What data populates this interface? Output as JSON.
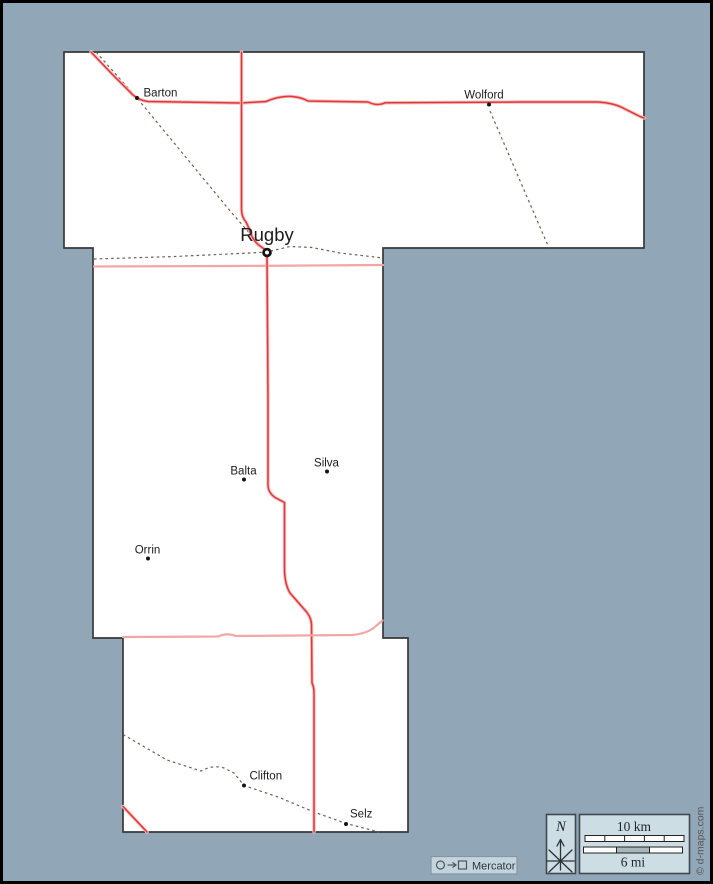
{
  "towns": [
    {
      "label": "Barton"
    },
    {
      "label": "Wolford"
    },
    {
      "label": "Rugby"
    },
    {
      "label": "Balta"
    },
    {
      "label": "Silva"
    },
    {
      "label": "Orrin"
    },
    {
      "label": "Clifton"
    },
    {
      "label": "Selz"
    }
  ],
  "legend": {
    "north": "N",
    "scale_km": "10 km",
    "scale_mi": "6 mi",
    "projection": "Mercator",
    "credit": "© d-maps.com"
  },
  "colors": {
    "background": "#91a7b8",
    "county_fill": "#ffffff",
    "county_border": "#383838",
    "road_primary": "#df3838",
    "road_casing": "#f7bcbc",
    "road_secondary": "#f3a6a6",
    "railroad": "#6b6052",
    "panel_fill": "#ccdde3",
    "panel_thin_fill": "#c2d4de"
  }
}
